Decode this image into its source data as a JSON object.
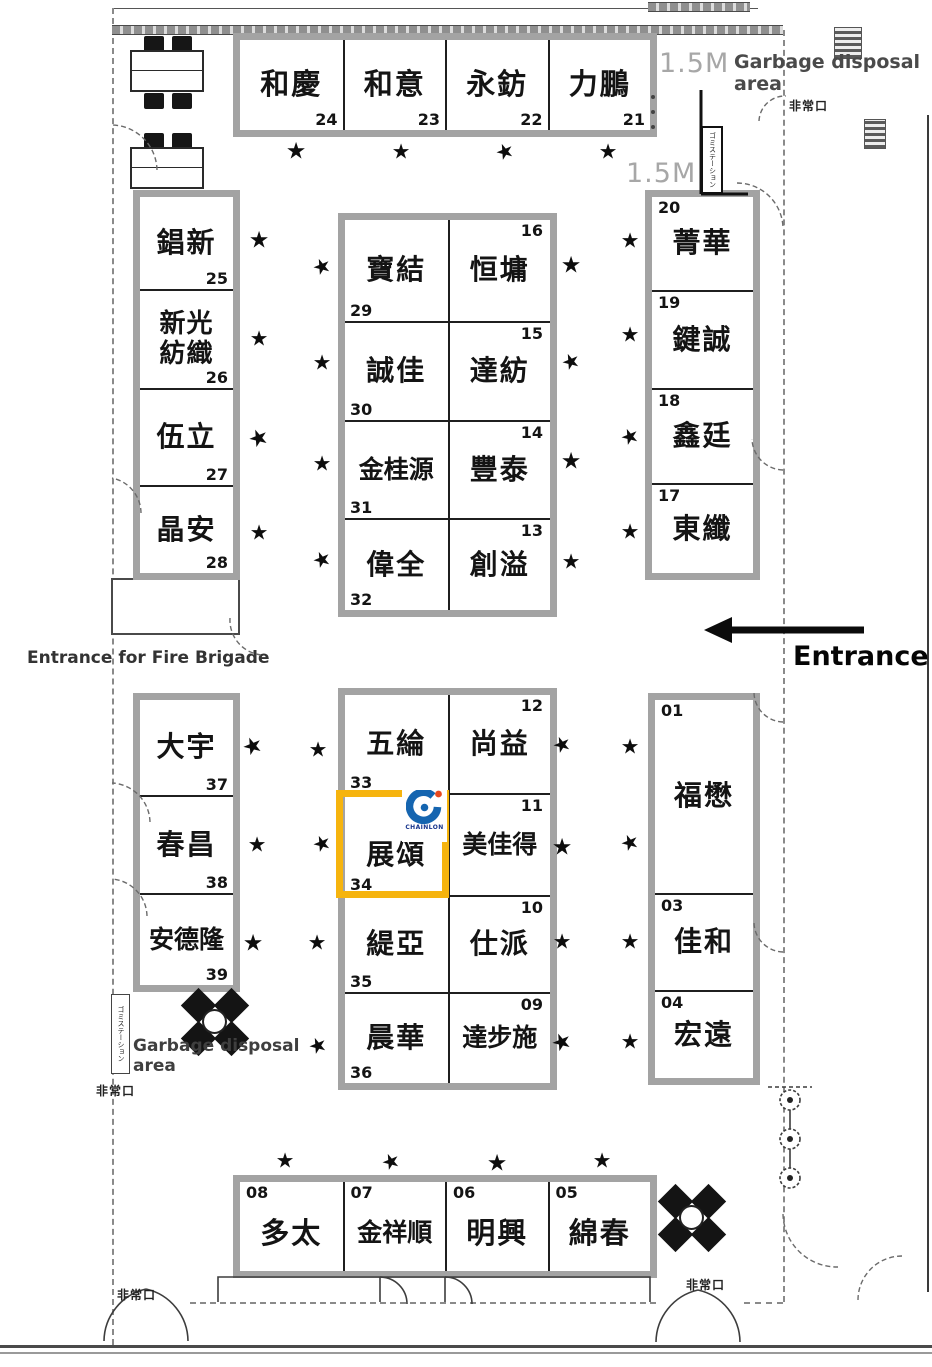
{
  "title": "exhibition-hall-floor-plan",
  "colors": {
    "highlight": "#F6B40E",
    "logo_blue": "#1565B0",
    "logo_red": "#E8491E",
    "logo_text_color": "#16348C",
    "wall_gray": "#A3A3A3"
  },
  "labels": {
    "m15_top": "1.5M",
    "m15_mid": "1.5M",
    "garbage_top_line1": "Garbage disposal",
    "garbage_top_line2": "area",
    "garbage_bottom_line1": "Garbage disposal",
    "garbage_bottom_line2": "area",
    "entrance": "Entrance",
    "fire_entrance": "Entrance for Fire Brigade",
    "exit_top_right": "非常口",
    "exit_garbage": "非常口",
    "exit_bottom_left": "非常口",
    "exit_bottom_right": "非常口",
    "station_top": "ゴミステーション",
    "station_left": "ゴミステーション",
    "star_glyph": "★"
  },
  "logo": {
    "text": "CHAINLON"
  },
  "highlight_booth": {
    "name": "展頌",
    "num": "34"
  },
  "blocks": {
    "top_row": [
      {
        "name": "和慶",
        "num": "24"
      },
      {
        "name": "和意",
        "num": "23"
      },
      {
        "name": "永鈁",
        "num": "22"
      },
      {
        "name": "力鵬",
        "num": "21"
      }
    ],
    "left_upper": [
      {
        "name": "錩新",
        "num": "25"
      },
      {
        "name": "新光紡織",
        "num": "26"
      },
      {
        "name": "伍立",
        "num": "27"
      },
      {
        "name": "晶安",
        "num": "28"
      }
    ],
    "mid_upper": [
      {
        "name": "寶結",
        "num": "29"
      },
      {
        "name": "恒墉",
        "num": "16"
      },
      {
        "name": "誠佳",
        "num": "30"
      },
      {
        "name": "達紡",
        "num": "15"
      },
      {
        "name": "金桂源",
        "num": "31"
      },
      {
        "name": "豐泰",
        "num": "14"
      },
      {
        "name": "偉全",
        "num": "32"
      },
      {
        "name": "創溢",
        "num": "13"
      }
    ],
    "right_upper": [
      {
        "name": "菁華",
        "num": "20"
      },
      {
        "name": "鍵誠",
        "num": "19"
      },
      {
        "name": "鑫廷",
        "num": "18"
      },
      {
        "name": "東纖",
        "num": "17"
      }
    ],
    "left_lower": [
      {
        "name": "大宇",
        "num": "37"
      },
      {
        "name": "春昌",
        "num": "38"
      },
      {
        "name": "安德隆",
        "num": "39"
      }
    ],
    "mid_lower": [
      {
        "name": "五綸",
        "num": "33"
      },
      {
        "name": "尚益",
        "num": "12"
      },
      {
        "name": "展頌",
        "num": "34"
      },
      {
        "name": "美佳得",
        "num": "11"
      },
      {
        "name": "緹亞",
        "num": "35"
      },
      {
        "name": "仕派",
        "num": "10"
      },
      {
        "name": "晨華",
        "num": "36"
      },
      {
        "name": "達步施",
        "num": "09"
      }
    ],
    "right_lower": [
      {
        "name": "福懋",
        "num": "01"
      },
      {
        "name": "佳和",
        "num": "03"
      },
      {
        "name": "宏遠",
        "num": "04"
      }
    ],
    "bottom_row": [
      {
        "name": "多太",
        "num": "08"
      },
      {
        "name": "金祥順",
        "num": "07"
      },
      {
        "name": "明興",
        "num": "06"
      },
      {
        "name": "綿春",
        "num": "05"
      }
    ]
  },
  "stars": [
    [
      296,
      152
    ],
    [
      401,
      152
    ],
    [
      505,
      152
    ],
    [
      608,
      152
    ],
    [
      259,
      241
    ],
    [
      322,
      267
    ],
    [
      259,
      339
    ],
    [
      322,
      363
    ],
    [
      259,
      439
    ],
    [
      322,
      464
    ],
    [
      259,
      533
    ],
    [
      322,
      560
    ],
    [
      571,
      266
    ],
    [
      630,
      241
    ],
    [
      571,
      362
    ],
    [
      630,
      335
    ],
    [
      571,
      462
    ],
    [
      630,
      437
    ],
    [
      571,
      562
    ],
    [
      630,
      532
    ],
    [
      253,
      747
    ],
    [
      318,
      750
    ],
    [
      257,
      845
    ],
    [
      322,
      844
    ],
    [
      253,
      944
    ],
    [
      317,
      943
    ],
    [
      562,
      745
    ],
    [
      630,
      747
    ],
    [
      562,
      848
    ],
    [
      630,
      843
    ],
    [
      562,
      942
    ],
    [
      630,
      942
    ],
    [
      562,
      1043
    ],
    [
      630,
      1042
    ],
    [
      285,
      1161
    ],
    [
      391,
      1162
    ],
    [
      497,
      1164
    ],
    [
      602,
      1161
    ],
    [
      318,
      1046
    ]
  ]
}
